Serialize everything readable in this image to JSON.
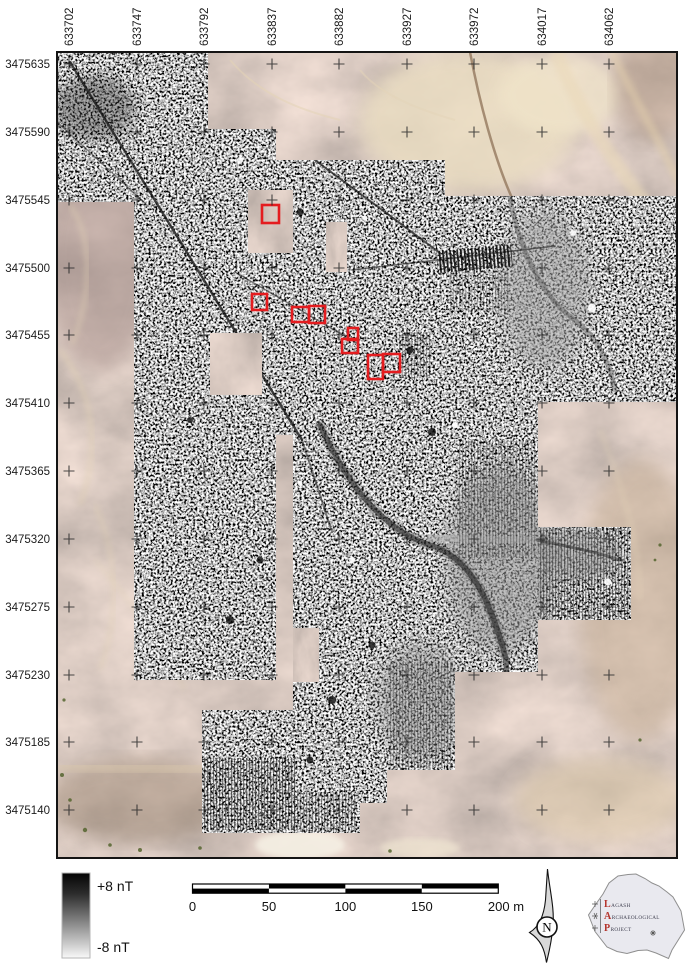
{
  "figure": {
    "type": "magnetometry-survey-map",
    "description": "Gradiometry survey greyscale plot overlaid on satellite imagery with excavation areas outlined in red"
  },
  "axes": {
    "top_labels": [
      "633702",
      "633747",
      "633792",
      "633837",
      "633882",
      "633927",
      "633972",
      "634017",
      "634062"
    ],
    "left_labels": [
      "3475635",
      "3475590",
      "3475545",
      "3475500",
      "3475455",
      "3475410",
      "3475365",
      "3475320",
      "3475275",
      "3475230",
      "3475185",
      "3475140"
    ]
  },
  "colorbar": {
    "max_label": "+8 nT",
    "min_label": "-8 nT"
  },
  "scale_bar": {
    "labels": [
      "0",
      "50",
      "100",
      "150",
      "200 m"
    ]
  },
  "north_arrow": {
    "label": "N"
  },
  "logo": {
    "line1_initial": "L",
    "line1_rest": "AGASH",
    "line2_initial": "A",
    "line2_rest": "RCHAEOLOGICAL",
    "line3_initial": "P",
    "line3_rest": "ROJECT"
  },
  "annotations": {
    "red_color": "#e41c1f",
    "red_rectangles": [
      {
        "x": 262,
        "y": 205,
        "w": 17,
        "h": 18
      },
      {
        "x": 252,
        "y": 294,
        "w": 15,
        "h": 16
      },
      {
        "x": 292,
        "y": 307,
        "w": 17,
        "h": 15
      },
      {
        "x": 309,
        "y": 306,
        "w": 16,
        "h": 17
      },
      {
        "x": 348,
        "y": 328,
        "w": 10,
        "h": 12
      },
      {
        "x": 342,
        "y": 339,
        "w": 16,
        "h": 14
      },
      {
        "x": 368,
        "y": 355,
        "w": 15,
        "h": 24
      },
      {
        "x": 383,
        "y": 354,
        "w": 17,
        "h": 18
      }
    ]
  }
}
